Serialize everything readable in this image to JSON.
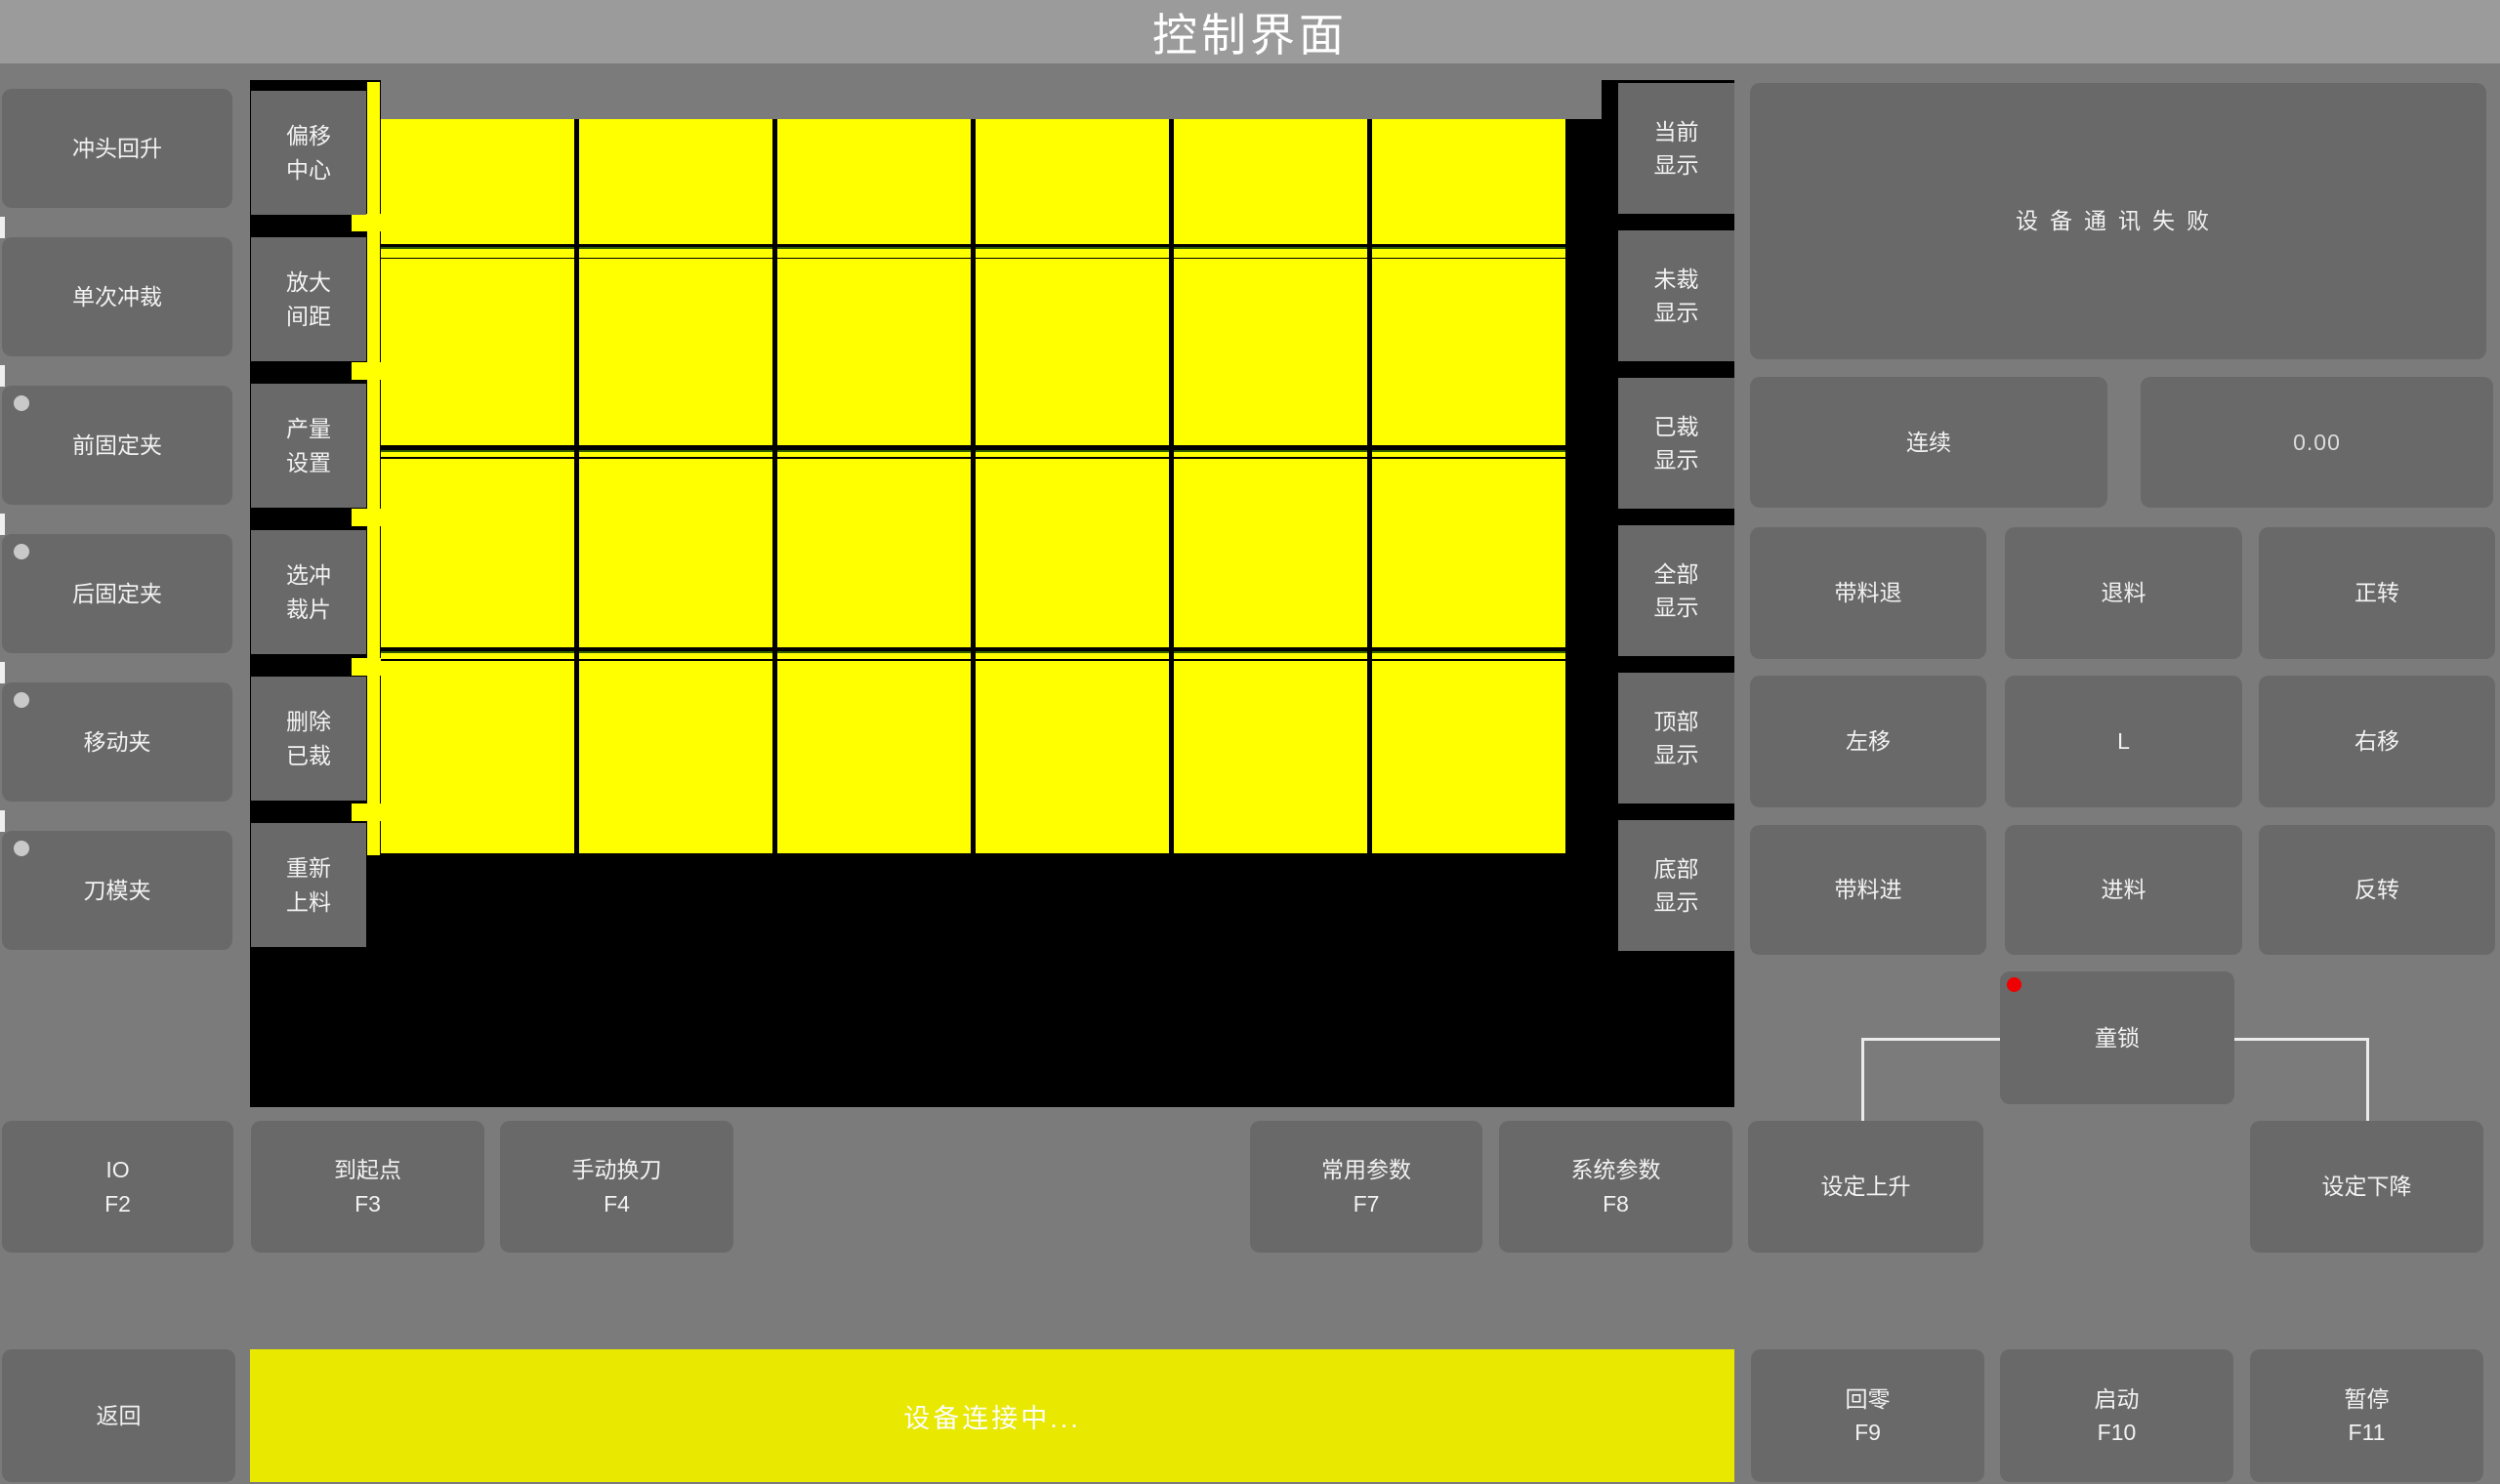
{
  "title": "控制界面",
  "colors": {
    "background_gray": "#7b7b7b",
    "titlebar_gray": "#9b9b9b",
    "button_gray": "#696969",
    "canvas_black": "#000000",
    "piece_yellow": "#ffff00",
    "status_bar_yellow": "#e8e800",
    "alert_red": "#f00000",
    "wire_white": "#ebebeb"
  },
  "left_panel": {
    "buttons": [
      {
        "label": "冲头回升",
        "indicator": false
      },
      {
        "label": "单次冲裁",
        "indicator": false
      },
      {
        "label": "前固定夹",
        "indicator": true
      },
      {
        "label": "后固定夹",
        "indicator": true
      },
      {
        "label": "移动夹",
        "indicator": true
      },
      {
        "label": "刀模夹",
        "indicator": true
      }
    ]
  },
  "tool_panel": {
    "buttons": [
      {
        "line1": "偏移",
        "line2": "中心"
      },
      {
        "line1": "放大",
        "line2": "间距"
      },
      {
        "line1": "产量",
        "line2": "设置"
      },
      {
        "line1": "选冲",
        "line2": "裁片"
      },
      {
        "line1": "删除",
        "line2": "已裁"
      },
      {
        "line1": "重新",
        "line2": "上料"
      }
    ]
  },
  "display_panel": {
    "buttons": [
      {
        "line1": "当前",
        "line2": "显示"
      },
      {
        "line1": "未裁",
        "line2": "显示"
      },
      {
        "line1": "已裁",
        "line2": "显示"
      },
      {
        "line1": "全部",
        "line2": "显示"
      },
      {
        "line1": "顶部",
        "line2": "显示"
      },
      {
        "line1": "底部",
        "line2": "显示"
      }
    ]
  },
  "canvas": {
    "columns": 6,
    "rows": 4,
    "cut_strip_rows": 3,
    "piece_color": "#ffff00"
  },
  "status_box": {
    "message": "设备通讯失败"
  },
  "feed_panel": {
    "mode_button": "连续",
    "value_display": "0.00",
    "grid": [
      [
        "带料退",
        "退料",
        "正转"
      ],
      [
        "左移",
        "L",
        "右移"
      ],
      [
        "带料进",
        "进料",
        "反转"
      ]
    ],
    "child_lock": "童锁"
  },
  "function_row": {
    "buttons": [
      {
        "label": "IO",
        "key": "F2"
      },
      {
        "label": "到起点",
        "key": "F3"
      },
      {
        "label": "手动换刀",
        "key": "F4"
      },
      {
        "label": "常用参数",
        "key": "F7"
      },
      {
        "label": "系统参数",
        "key": "F8"
      },
      {
        "label": "设定上升",
        "key": ""
      },
      {
        "label": "设定下降",
        "key": ""
      }
    ]
  },
  "bottom_bar": {
    "back": "返回",
    "status": "设备连接中...",
    "buttons": [
      {
        "label": "回零",
        "key": "F9"
      },
      {
        "label": "启动",
        "key": "F10"
      },
      {
        "label": "暂停",
        "key": "F11"
      }
    ]
  }
}
